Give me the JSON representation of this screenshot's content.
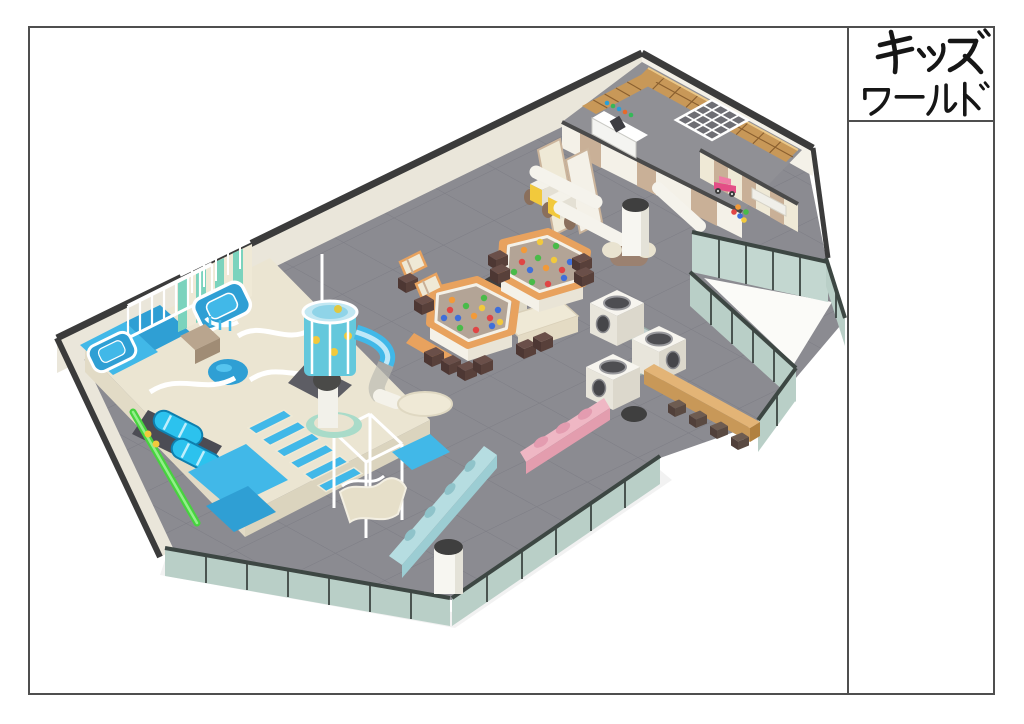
{
  "sheet": {
    "background": "#ffffff",
    "frame_color": "#4f4f4f"
  },
  "title_block": {
    "line1": "キッズ",
    "line2": "ワールド"
  },
  "palette": {
    "frame": "#4f4f4f",
    "wallTop": "#3b3b3b",
    "wallFace": "#eae6da",
    "wallFaceLight": "#f4f1e8",
    "floor": "#8b8b91",
    "roomFloor": "#909095",
    "glass": "#b9cfc7",
    "glassFrame": "#3d4743",
    "playBlue": "#41b8e8",
    "playBlueDeep": "#2f9fd4",
    "teal": "#7bd3bd",
    "cream": "#efe9d6",
    "green": "#47d33f",
    "woodOrange": "#e8a25e",
    "wood": "#c89858",
    "tan": "#c9b097",
    "brownWall": "#9b8170",
    "ottoman": "#4d3733",
    "pink": "#efb7c4",
    "pinkDark": "#e39dae",
    "blueBench": "#b6dde1",
    "blueBenchDark": "#9ccdd3",
    "stool": "#57463e",
    "carPink": "#e34e86",
    "yellow": "#f2c93c",
    "ballRed": "#e04545",
    "ballBlue": "#3f6fd9",
    "ballGreen": "#49bb49",
    "ballOrange": "#f29a39"
  },
  "scene": {
    "description": "Isometric 3D render of an indoor kids playground floor plan",
    "elements": [
      "entrance shoe lockers",
      "reception counter",
      "white lattice ceiling",
      "toddler room with pink toy car",
      "two hexagonal ball pits with colorful balls",
      "soft play structure with trampolines, rollers and net frames",
      "spiral tube slide tower",
      "wavy slide with safety cage",
      "climbing cubes with glass tunnels",
      "green fireman pole",
      "pink bench",
      "light blue bench",
      "wooden bench with stools",
      "teal glass partition walls",
      "white columns with dark caps"
    ]
  }
}
